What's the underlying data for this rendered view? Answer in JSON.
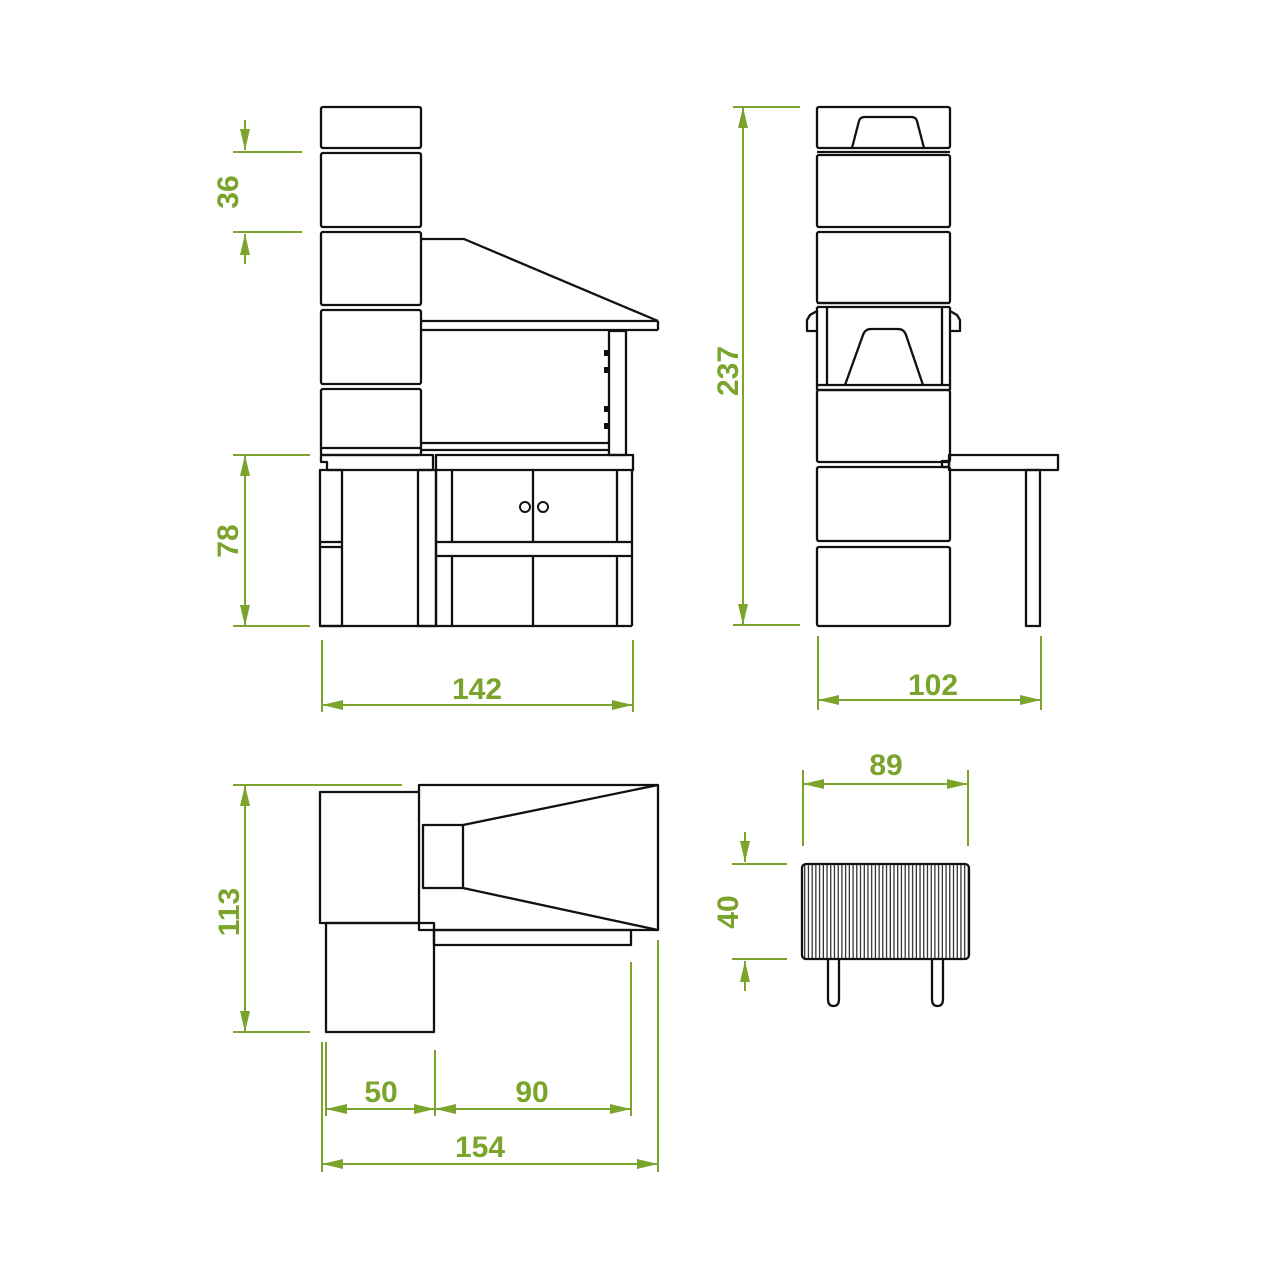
{
  "drawing": {
    "type": "technical-orthographic-drawing",
    "subject": "masonry-barbecue",
    "colors": {
      "background": "#ffffff",
      "line": "#111111",
      "dimension": "#7AA42C"
    },
    "views": {
      "front": {
        "course_height": "36",
        "base_height": "78",
        "width": "142"
      },
      "side": {
        "total_height": "237",
        "depth": "102"
      },
      "plan": {
        "depth": "113",
        "side_table_width": "50",
        "firebox_width": "90",
        "total_width": "154"
      },
      "grate": {
        "width": "89",
        "depth": "40"
      }
    }
  }
}
